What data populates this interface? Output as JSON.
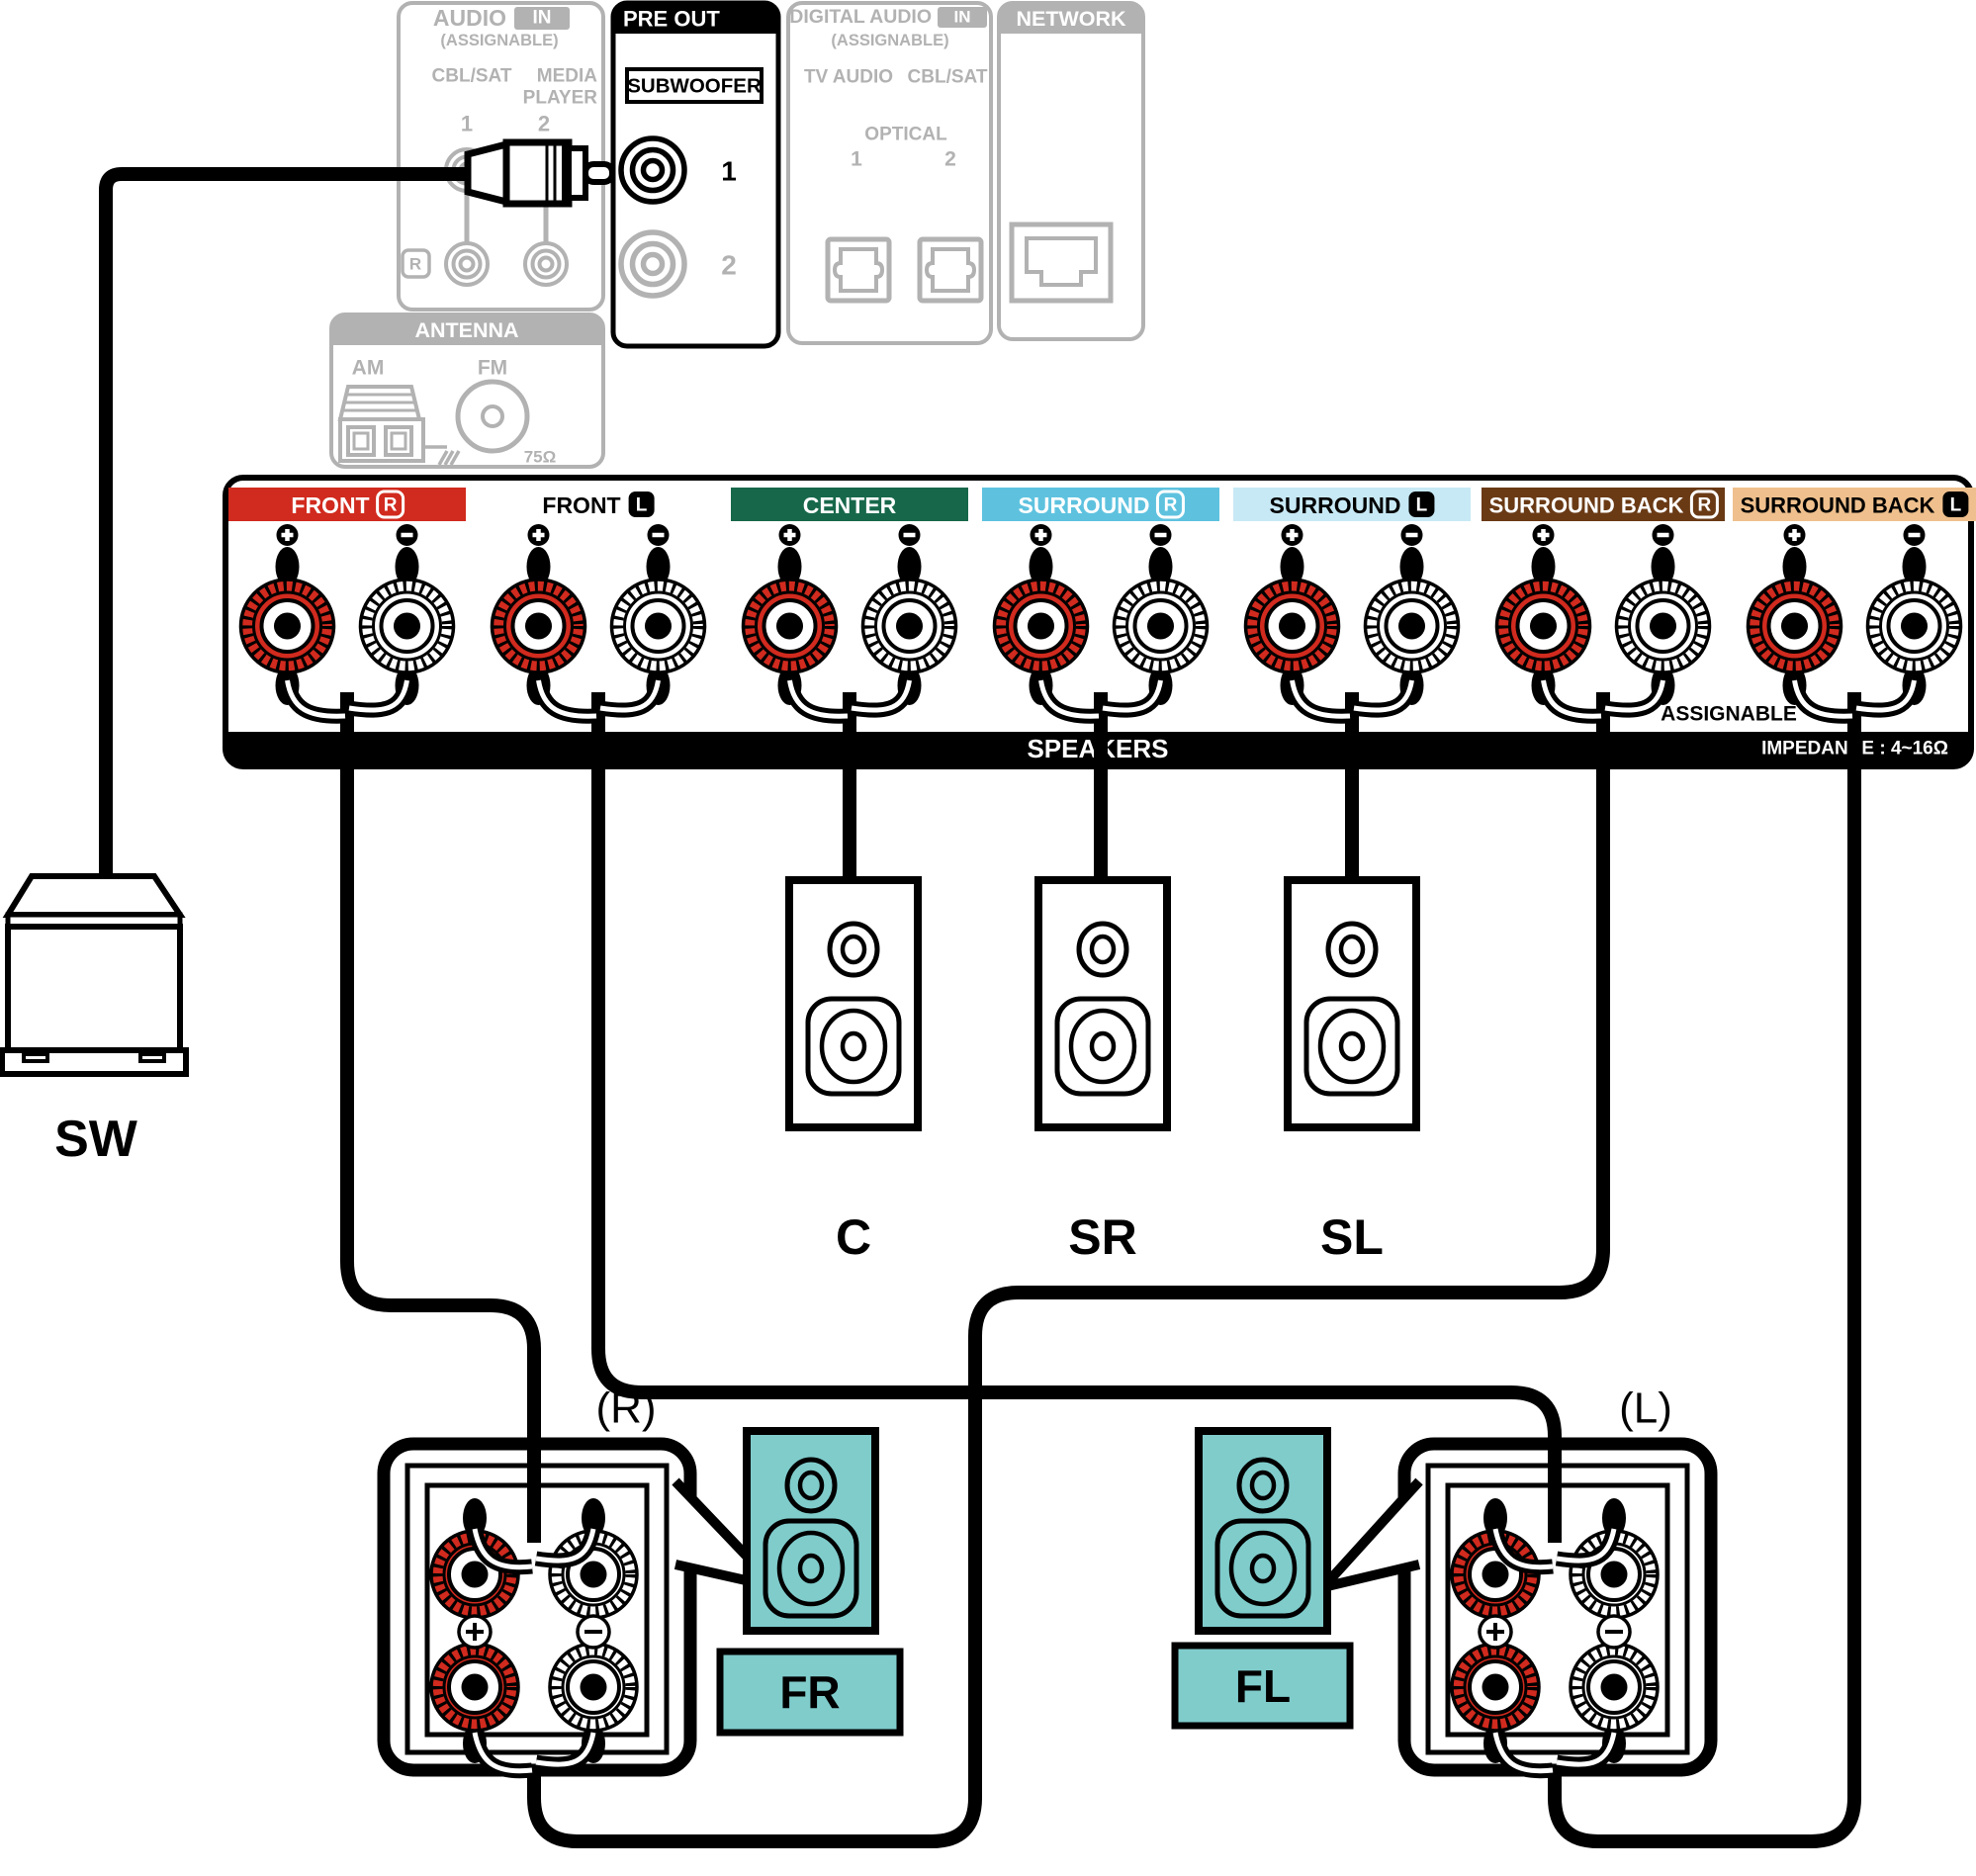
{
  "colors": {
    "red": "#d12a1e",
    "green": "#17684b",
    "blue": "#5ec2df",
    "pale_blue": "#c7e9f5",
    "brown": "#6a3a15",
    "tan": "#efc08d",
    "teal": "#7fcccb",
    "gray": "#b2b2b2",
    "black": "#000000",
    "white": "#ffffff"
  },
  "rear_panel": {
    "audio_in": {
      "title": "AUDIO",
      "badge": "IN",
      "assignable": "(ASSIGNABLE)",
      "jack_group1": "CBL/SAT",
      "jack_group2_line1": "MEDIA",
      "jack_group2_line2": "PLAYER",
      "num1": "1",
      "num2": "2",
      "row_r": "R"
    },
    "pre_out": {
      "title": "PRE OUT",
      "subwoofer": "SUBWOOFER",
      "jack1": "1",
      "jack2": "2"
    },
    "digital_audio_in": {
      "title": "DIGITAL AUDIO",
      "badge": "IN",
      "assignable": "(ASSIGNABLE)",
      "jack1_label": "TV AUDIO",
      "jack2_label": "CBL/SAT",
      "optical": "OPTICAL",
      "num1": "1",
      "num2": "2"
    },
    "network": {
      "title": "NETWORK"
    },
    "antenna": {
      "title": "ANTENNA",
      "am": "AM",
      "fm": "FM",
      "impedance": "75Ω"
    }
  },
  "speaker_panel": {
    "terminals": [
      {
        "label": "FRONT",
        "channel": "R",
        "style": "front_r"
      },
      {
        "label": "FRONT",
        "channel": "L",
        "style": "front_l"
      },
      {
        "label": "CENTER",
        "channel": null,
        "style": "center"
      },
      {
        "label": "SURROUND",
        "channel": "R",
        "style": "surround_r"
      },
      {
        "label": "SURROUND",
        "channel": "L",
        "style": "surround_l"
      },
      {
        "label": "SURROUND BACK",
        "channel": "R",
        "style": "surround_back_r"
      },
      {
        "label": "SURROUND BACK",
        "channel": "L",
        "style": "surround_back_l"
      }
    ],
    "speakers_label": "SPEAKERS",
    "assignable_label": "ASSIGNABLE",
    "impedance_label": "IMPEDANCE : 4~16Ω"
  },
  "speakers": {
    "subwoofer": "SW",
    "center": "C",
    "surround_r": "SR",
    "surround_l": "SL",
    "front_r": "FR",
    "front_l": "FL",
    "right_tag": "(R)",
    "left_tag": "(L)"
  }
}
